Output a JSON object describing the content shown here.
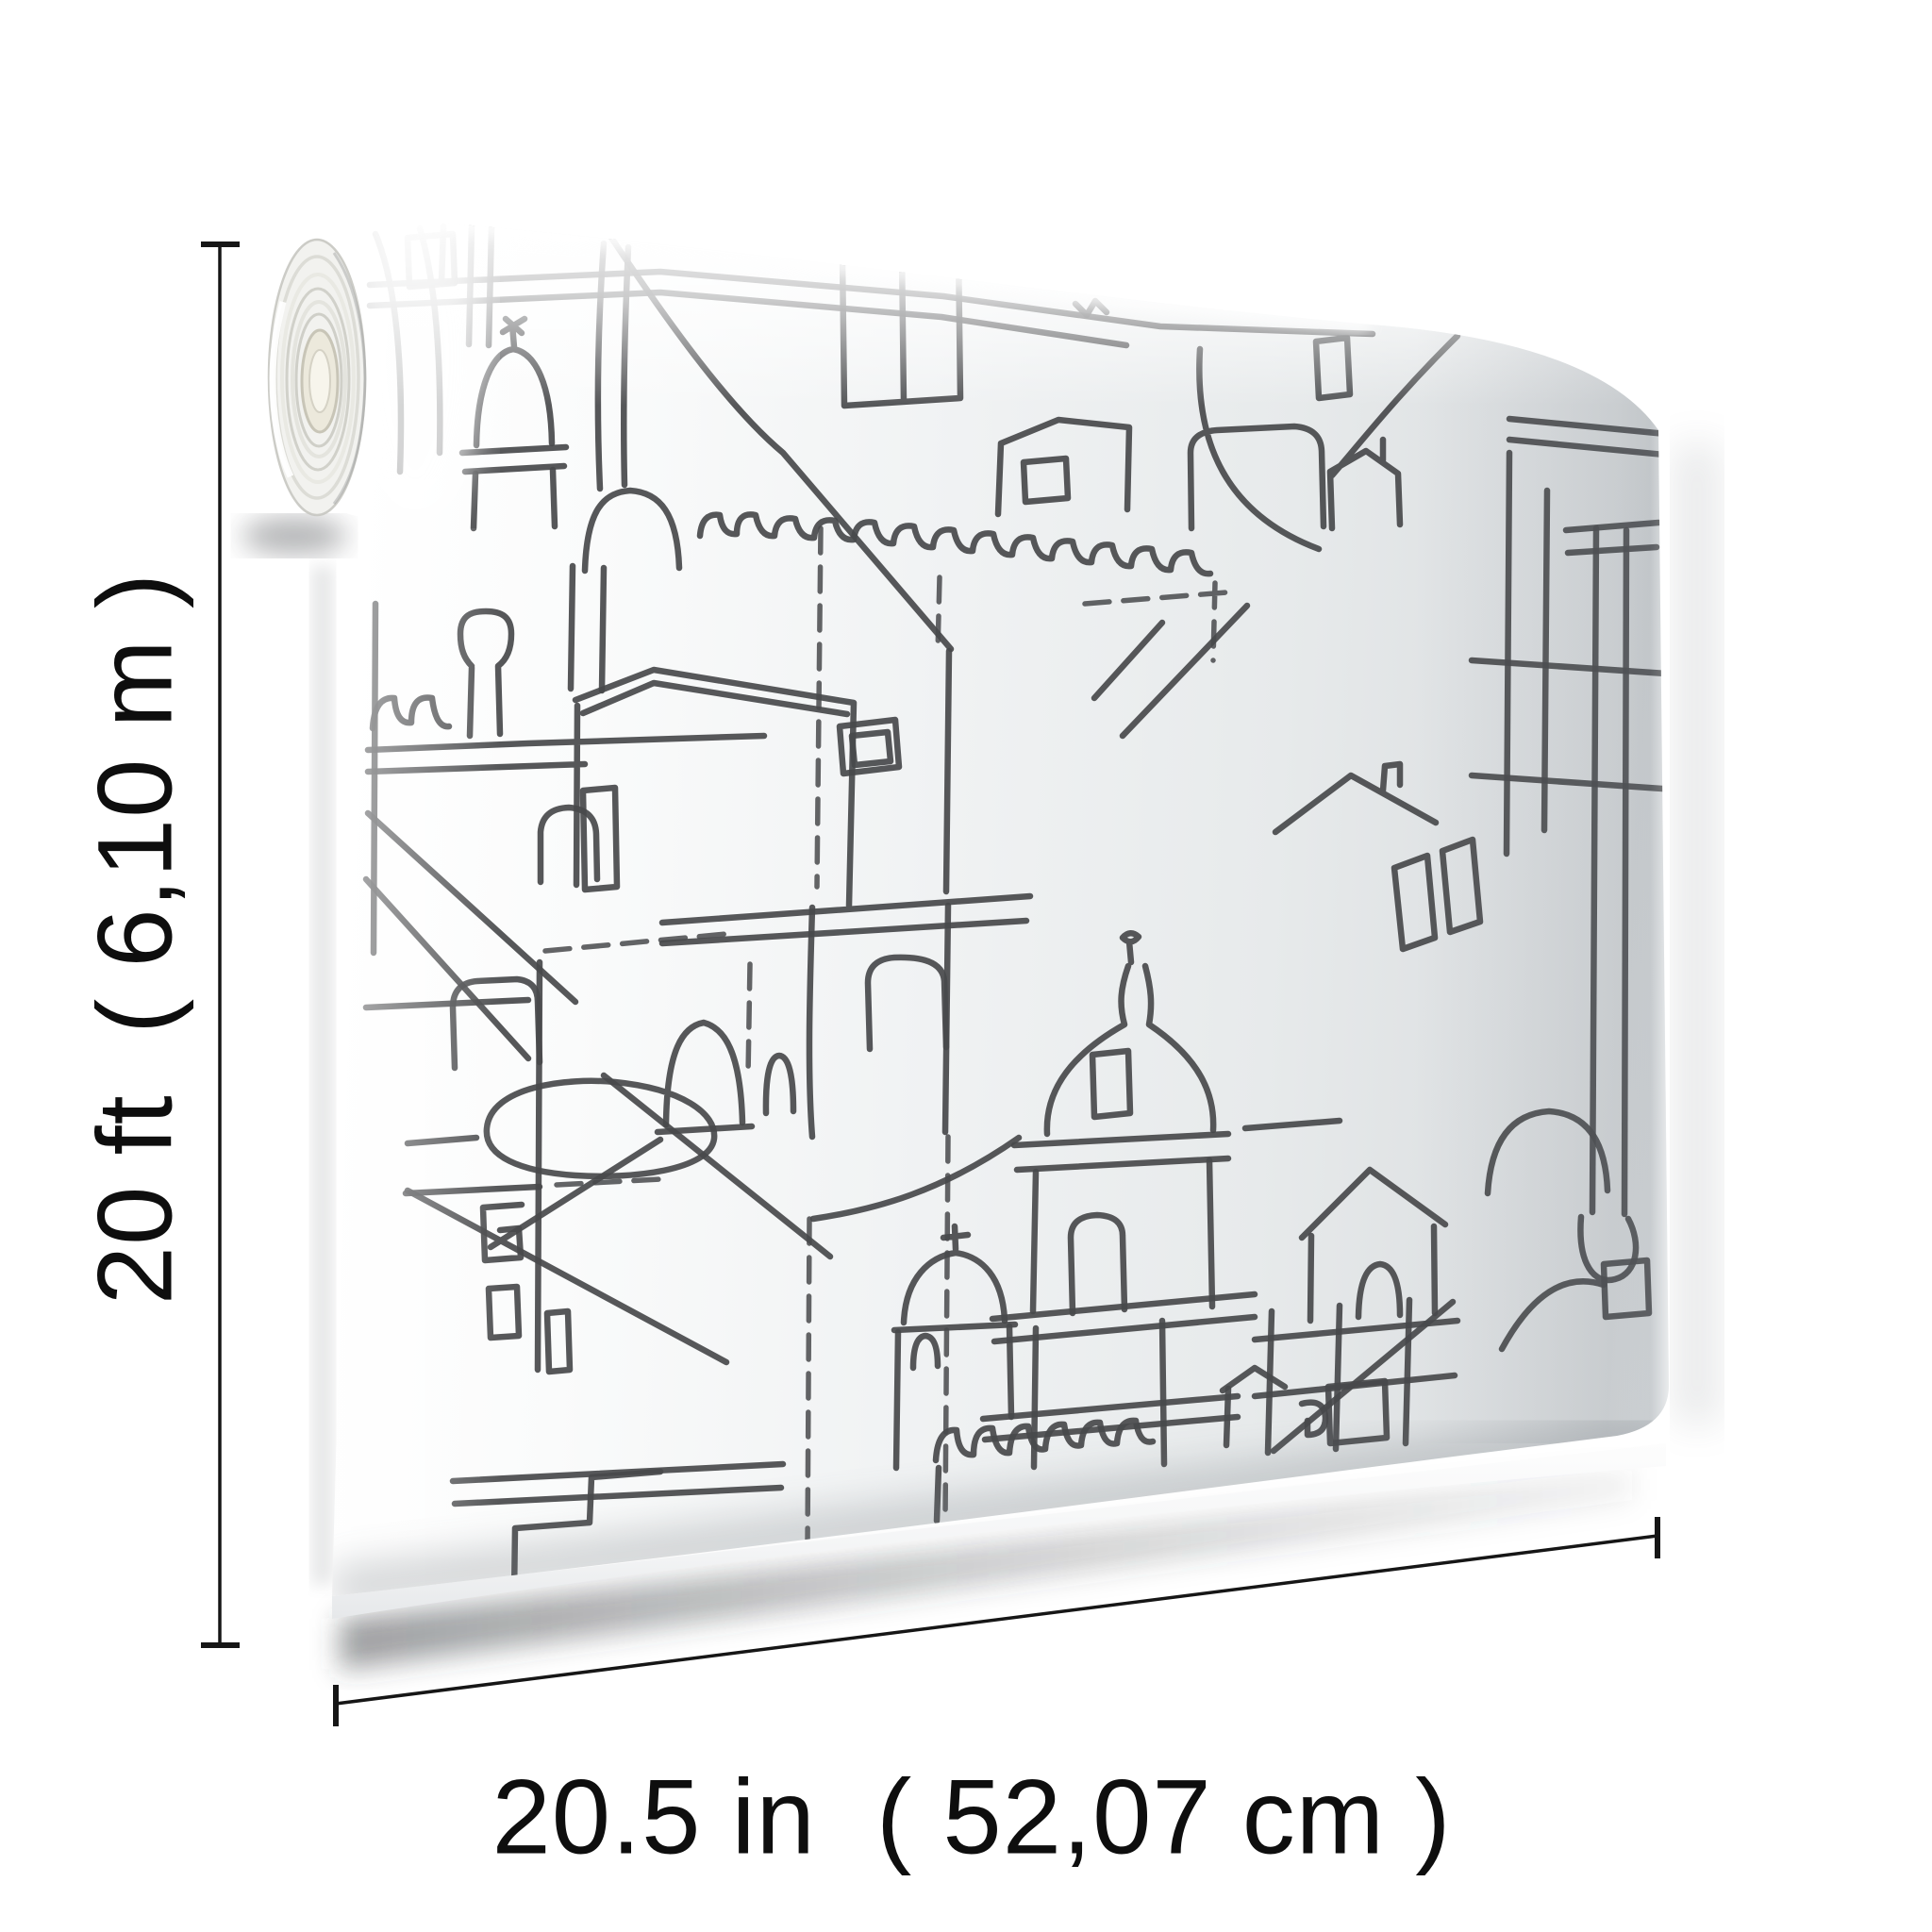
{
  "annotation": {
    "height_label": "20 ft  ( 6,10 m )",
    "width_label": "20.5 in  ( 52,07 cm )"
  },
  "product": {
    "item": "Wallpaper roll shown partially unrolled",
    "artwork": "Abstract black sketch line-drawing cityscape with domes, bell towers, arches, windows and rooftops on a white ground"
  },
  "colors": {
    "background": "#ffffff",
    "sketch_ink": "#48494b",
    "sheet_tint": "#e8eaec",
    "dimension_ink": "#111111",
    "roll_core": "#efece0"
  }
}
